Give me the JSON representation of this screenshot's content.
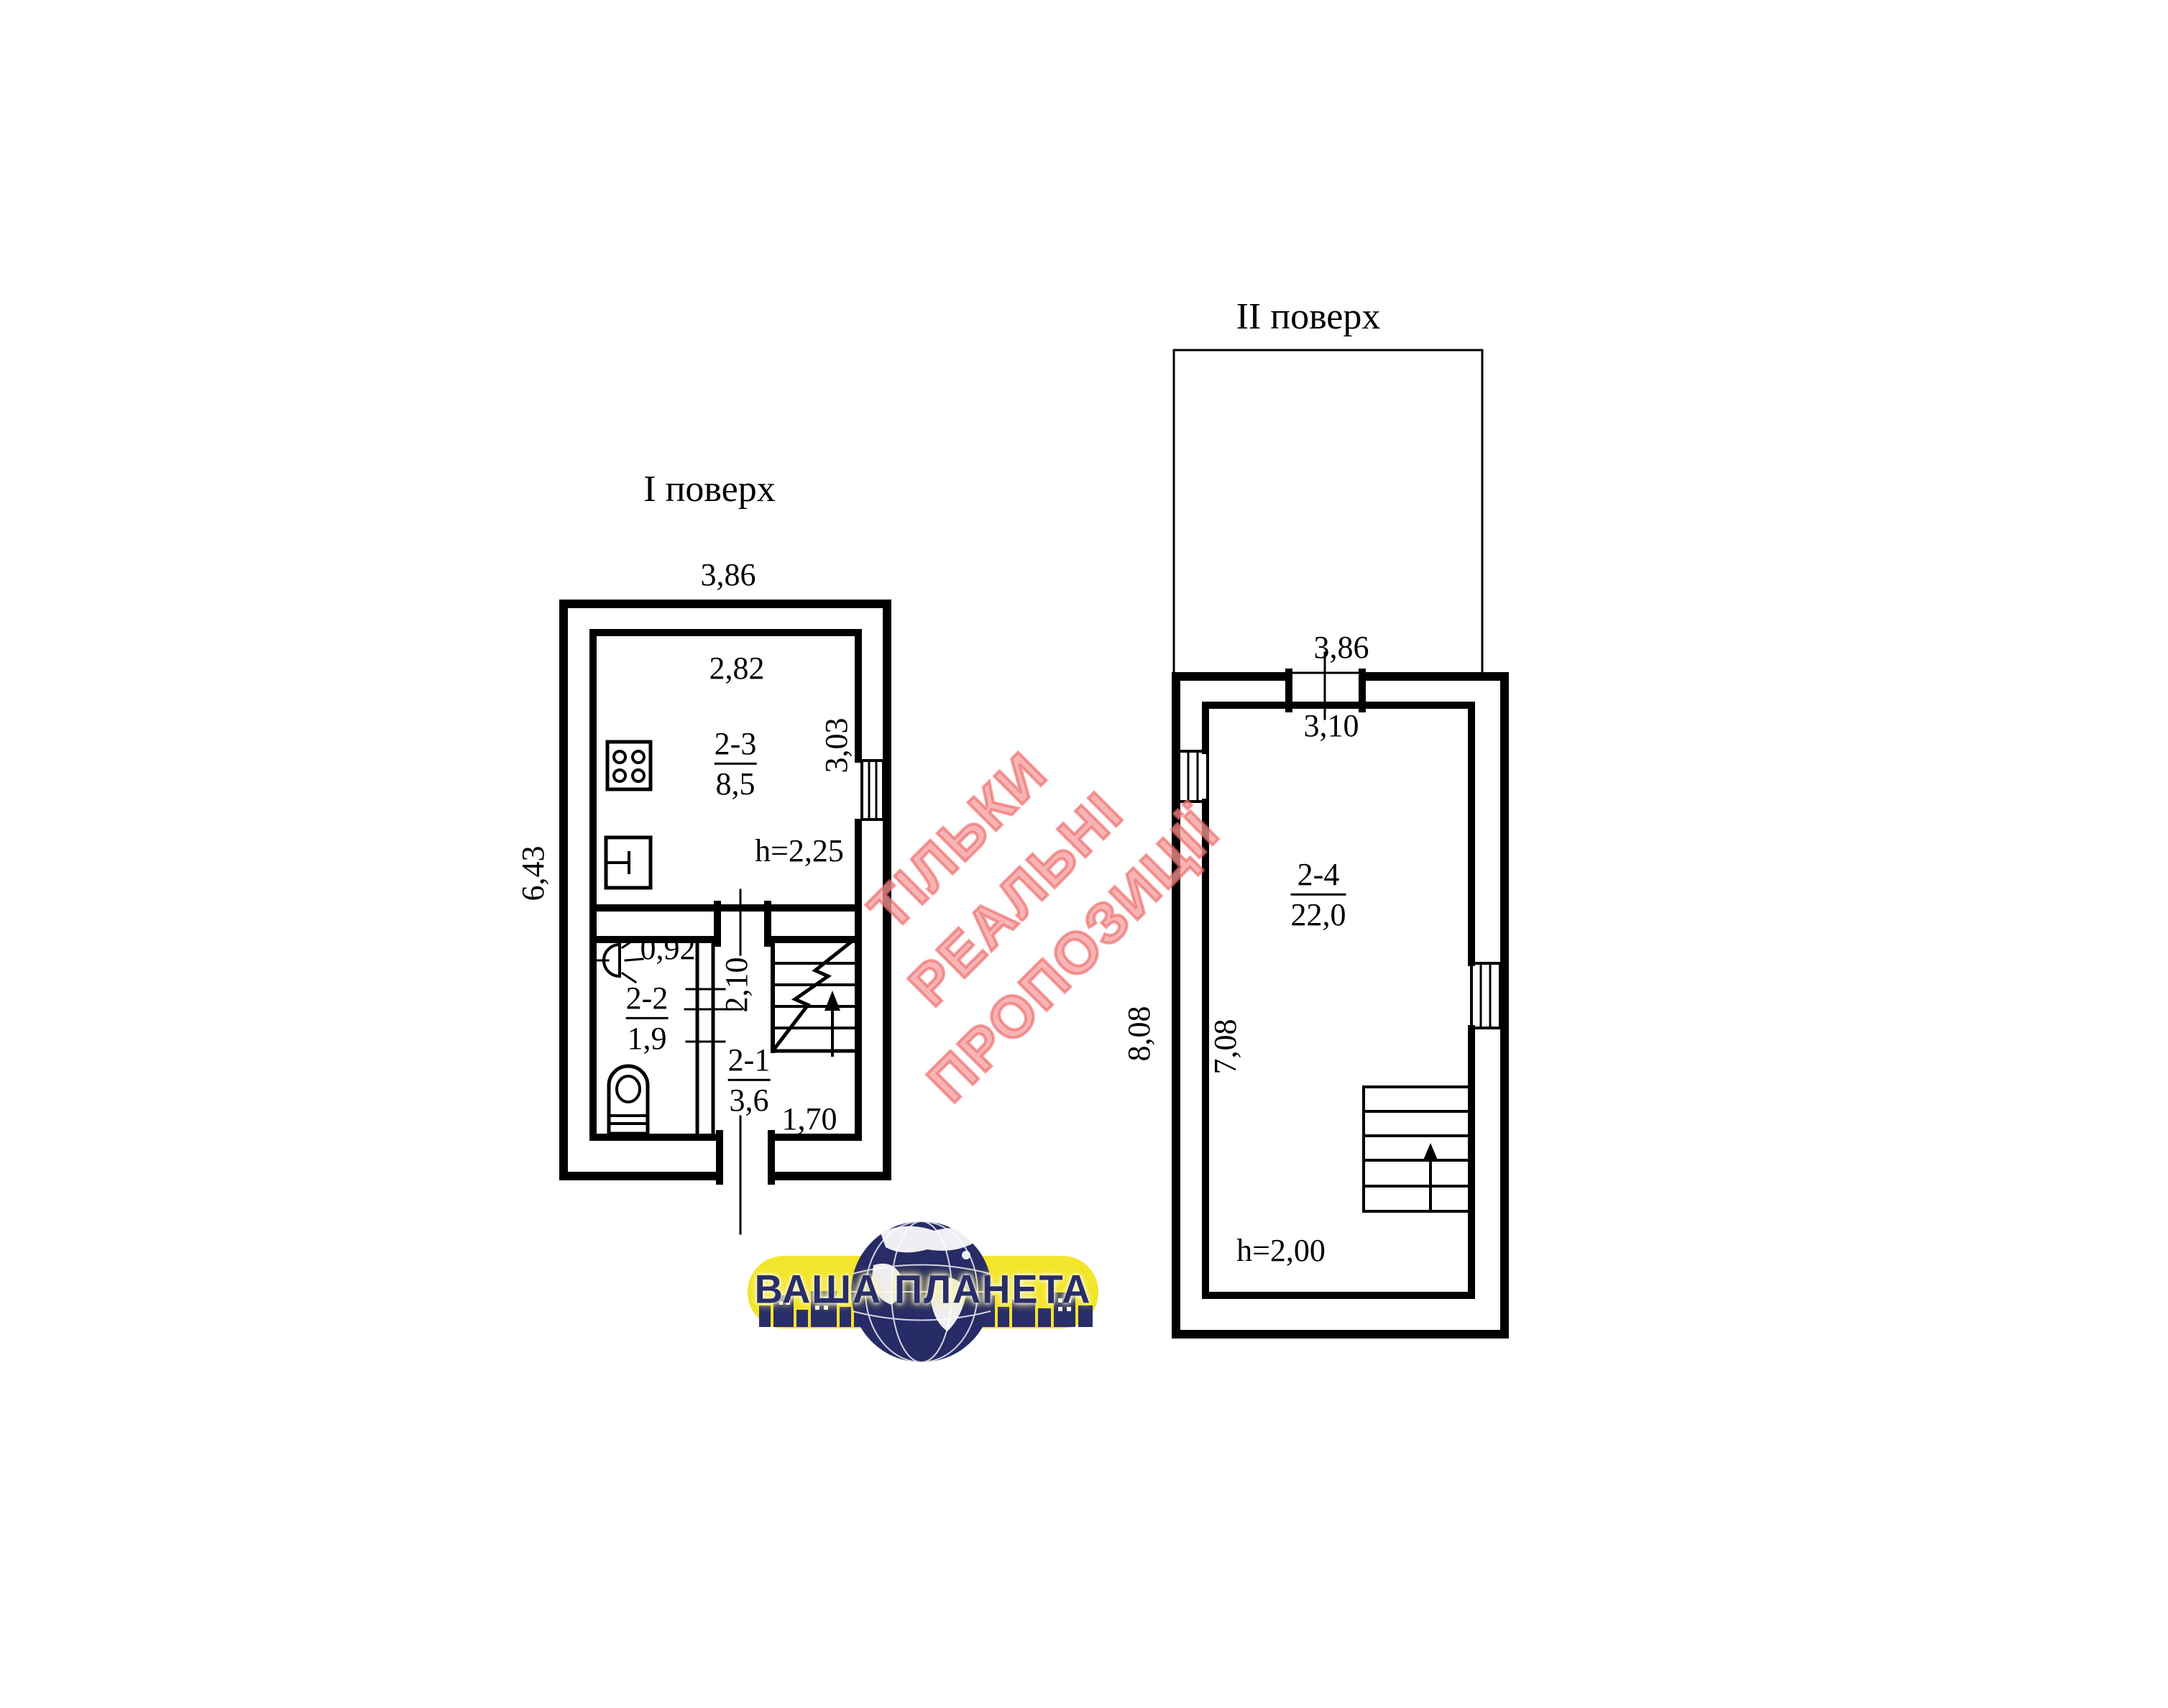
{
  "floor1": {
    "title": "І поверх",
    "dims": {
      "top_width": "3,86",
      "left_height": "6,43"
    },
    "kitchen": {
      "label": "2-3",
      "area": "8,5",
      "width": "2,82",
      "height": "3,03",
      "ceiling_height": "h=2,25"
    },
    "bathroom": {
      "label": "2-2",
      "area": "1,9",
      "door_width": "0,92"
    },
    "hallway": {
      "label": "2-1",
      "area": "3,6",
      "depth": "2,10",
      "width": "1,70"
    }
  },
  "floor2": {
    "title": "ІІ поверх",
    "dims": {
      "top_width": "3,86",
      "outer_height": "8,08"
    },
    "room": {
      "label": "2-4",
      "area": "22,0",
      "width": "3,10",
      "height": "7,08",
      "ceiling_height": "h=2,00"
    }
  },
  "watermark": {
    "line1": "ТІЛЬКИ",
    "line2": "РЕАЛЬНІ",
    "line3": "ПРОПОЗИЦІЇ"
  },
  "logo": {
    "title": "ВАША ПЛАНЕТА"
  },
  "colors": {
    "line": "#000000",
    "watermark": "#ee8585",
    "logo_banner": "#f3e52b",
    "logo_navy": "#2a2e68"
  },
  "icons": {
    "stove": "stove-icon",
    "sink": "sink-icon",
    "toilet": "toilet-icon",
    "sconce": "wall-lamp-icon",
    "stairs_floor1": "stairs-up-icon",
    "stairs_floor2": "stairs-up-icon",
    "windows": "window-hatch-icon",
    "globe": "globe-icon"
  }
}
